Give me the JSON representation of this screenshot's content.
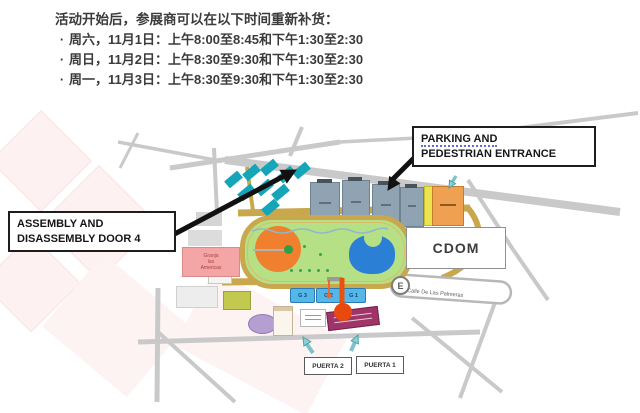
{
  "notice": {
    "bullet": "·",
    "title": "活动开始后，参展商可以在以下时间重新补货：",
    "items": [
      "周六，11月1日：上午8:00至8:45和下午1:30至2:30",
      "周日，11月2日：上午8:30至9:30和下午1:30至2:30",
      "周一，11月3日：上午8:30至9:30和下午1:30至2:30"
    ]
  },
  "map": {
    "callouts": {
      "parking_line1": "PARKING AND",
      "parking_line2": "PEDESTRIAN ENTRANCE",
      "assembly_line1": "ASSEMBLY AND",
      "assembly_line2": "DISASSEMBLY DOOR 4"
    },
    "buildings": {
      "cdom": "CDOM",
      "granja_lines": [
        "Granja",
        "las",
        "Americas"
      ]
    },
    "gates": {
      "puerta1": "PUERTA 1",
      "puerta2": "PUERTA 2",
      "g_labels": [
        "G 3",
        "G 2",
        "G 1"
      ]
    },
    "streets": {
      "palmeras": "Calle De Las Palmeras"
    },
    "symbols": {
      "parking_badge": "E"
    },
    "colors": {
      "teal_building": "#14a5b8",
      "gray_building": "#8fa3b3",
      "track_ring": "#c9a84d",
      "infield": "#b5e085",
      "pond": "#2b7fd4",
      "center_circle": "#f07f2e",
      "pin": "#e8490f",
      "gate_blue": "#55b7e8",
      "granja_pink": "#f4a5a5",
      "magenta_block": "#a03468",
      "watermark_pink": "#fdf1f1"
    }
  }
}
